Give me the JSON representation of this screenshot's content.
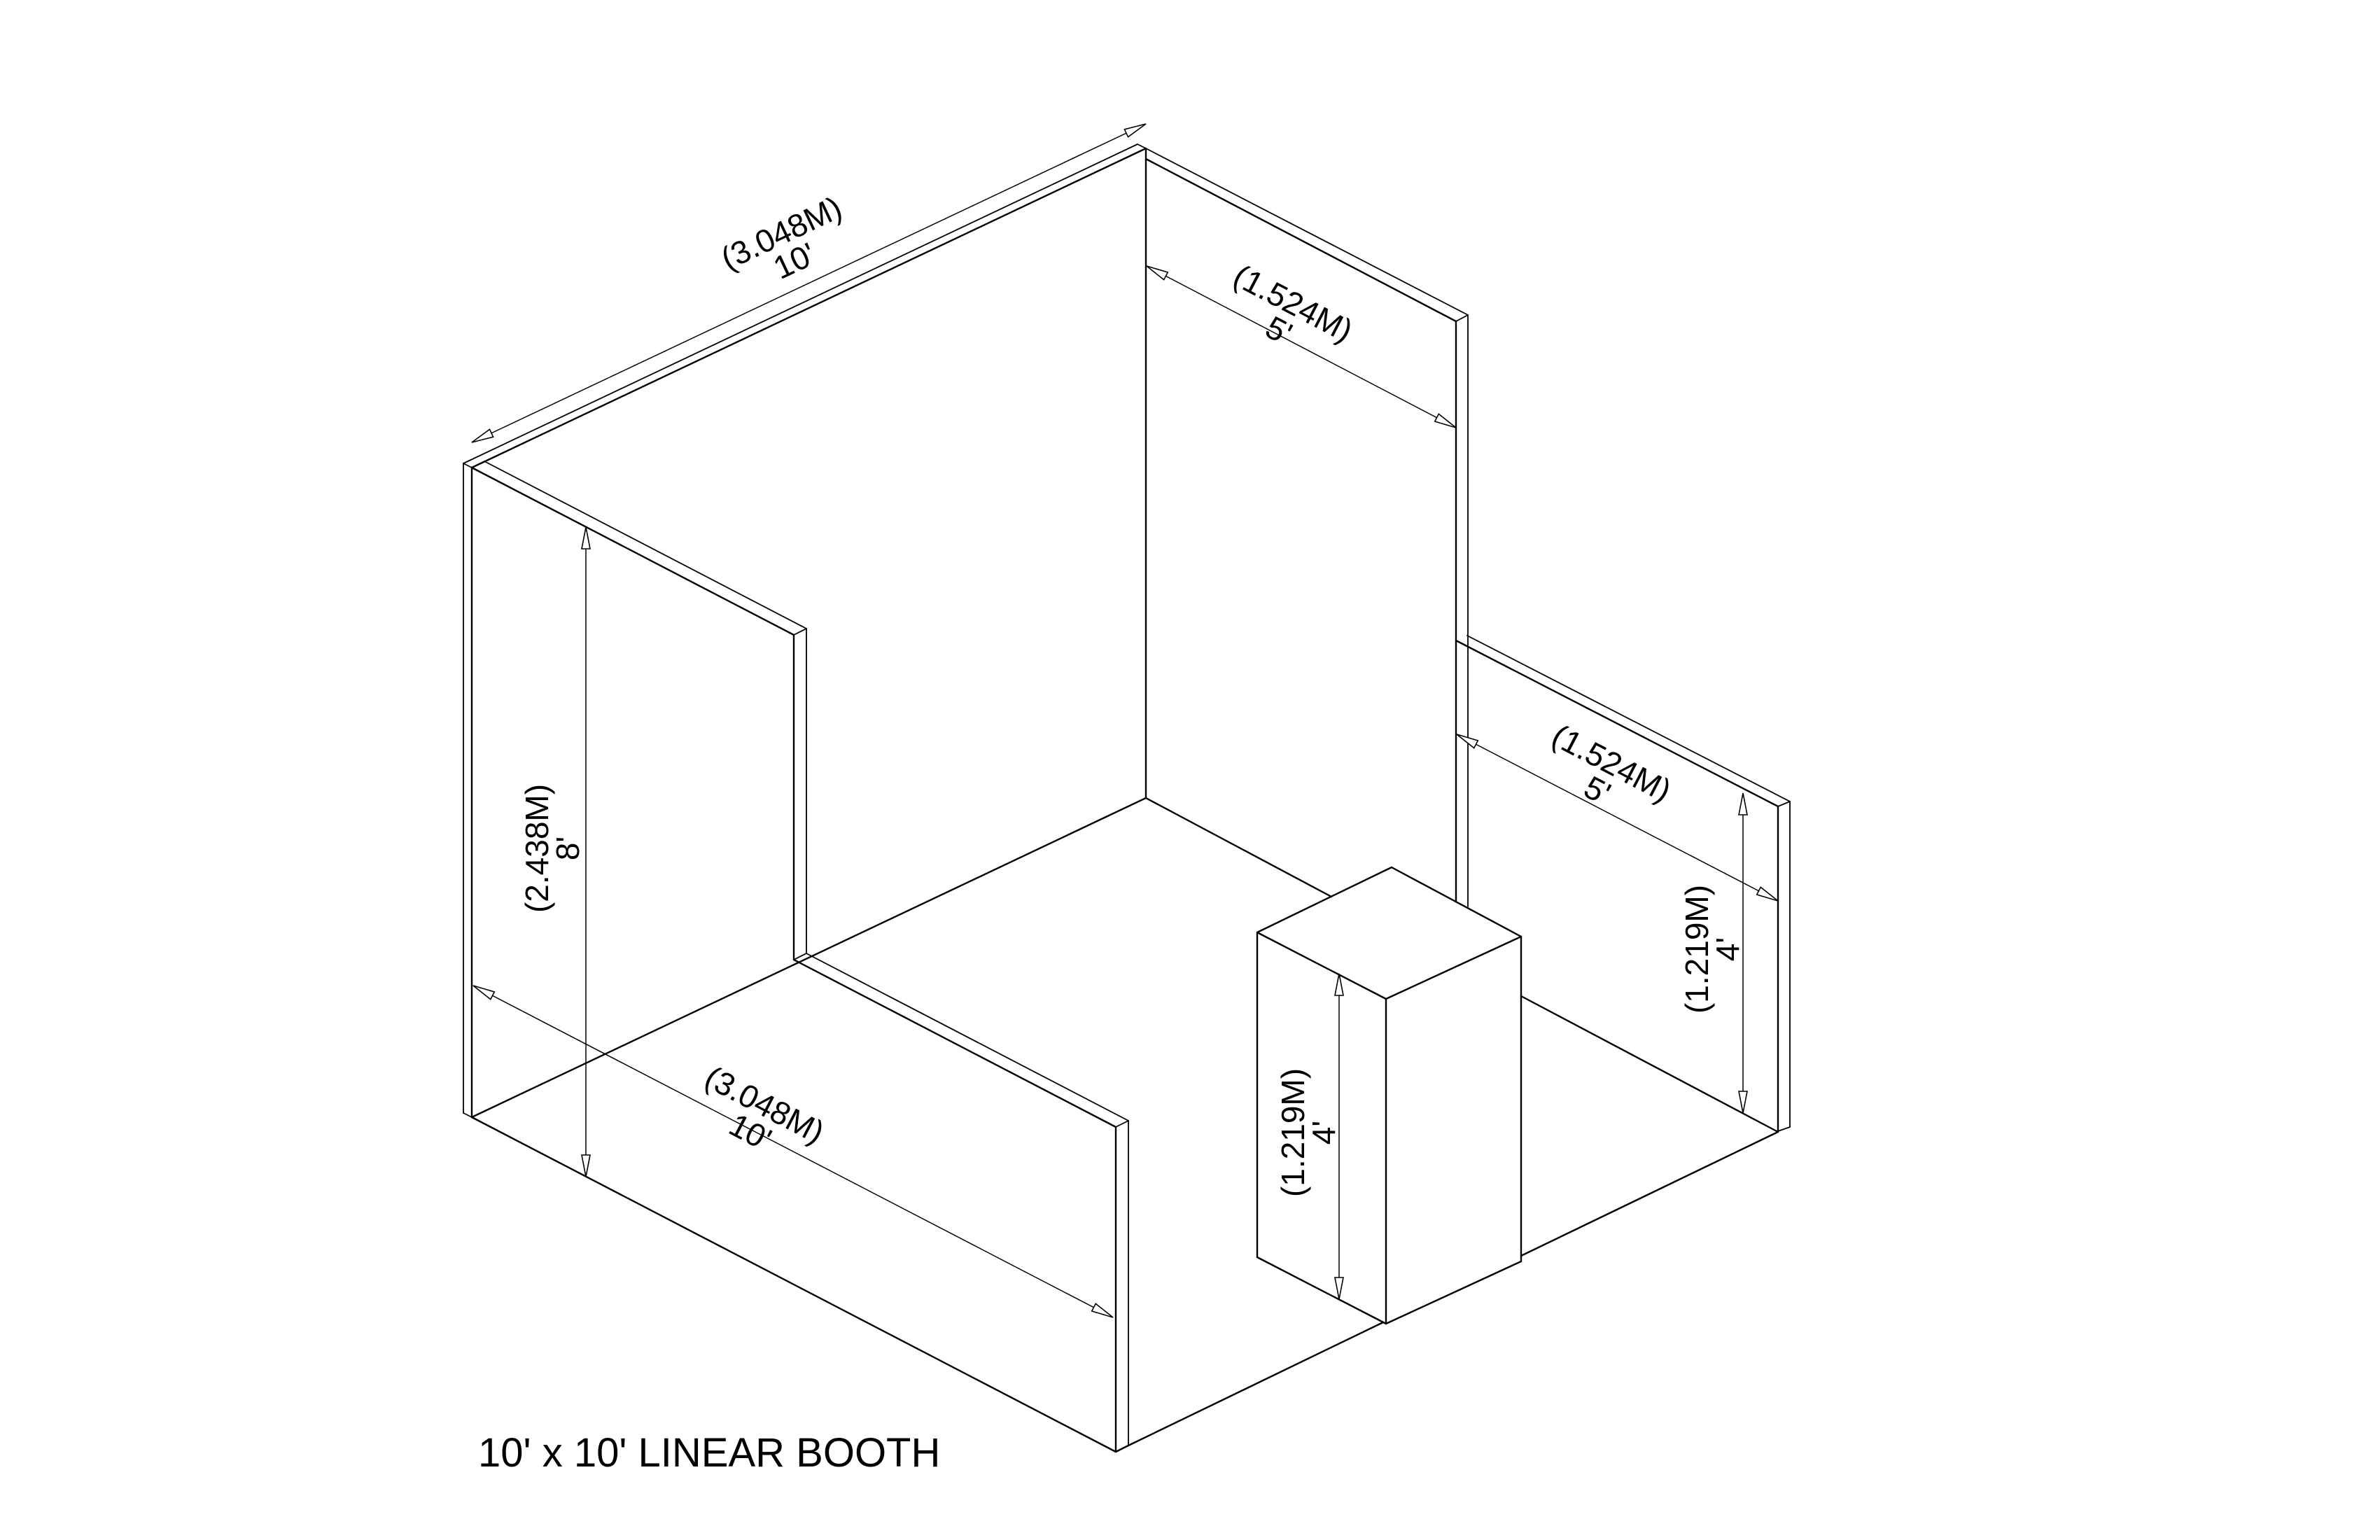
{
  "title": "10' x 10' LINEAR BOOTH",
  "colors": {
    "line": "#000000",
    "background": "#ffffff"
  },
  "dimensions": {
    "back_wall_width": {
      "metric": "(3.048M)",
      "imperial": "10'"
    },
    "rear_sidewall_length": {
      "metric": "(1.524M)",
      "imperial": "5'"
    },
    "wall_height": {
      "metric": "(2.438M)",
      "imperial": "8'"
    },
    "sidewall_total_depth": {
      "metric": "(3.048M)",
      "imperial": "10'"
    },
    "pedestal_height": {
      "metric": "(1.219M)",
      "imperial": "4'"
    },
    "front_sidewall_length": {
      "metric": "(1.524M)",
      "imperial": "5'"
    },
    "front_sidewall_height": {
      "metric": "(1.219M)",
      "imperial": "4'"
    }
  }
}
